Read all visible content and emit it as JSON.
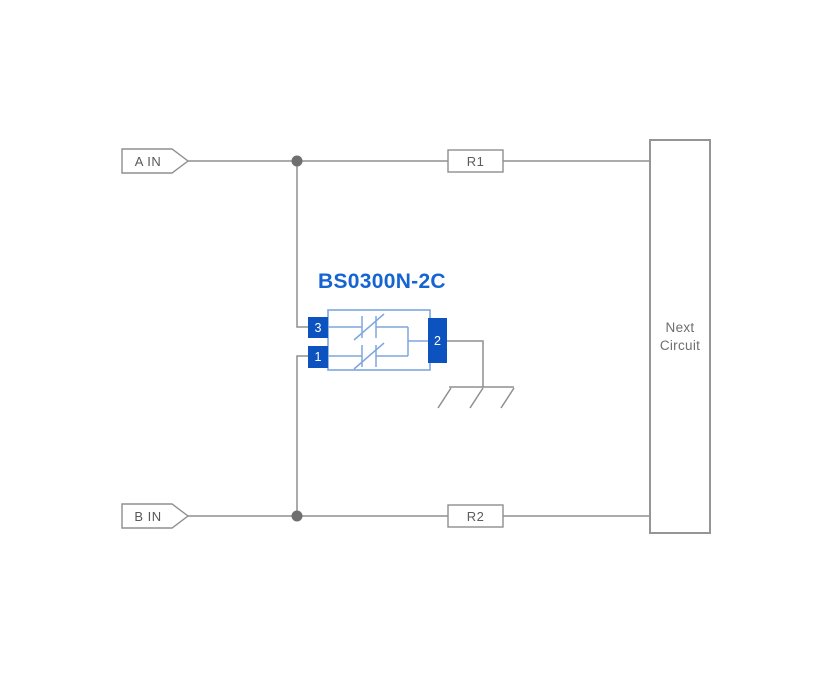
{
  "diagram": {
    "type": "circuit-schematic",
    "component": {
      "title": "BS0300N-2C",
      "pin_top_left": "3",
      "pin_bottom_left": "1",
      "pin_right": "2",
      "internal_symbol": "dual-bidirectional-esd-diode"
    },
    "input_a": "A IN",
    "input_b": "B IN",
    "resistor_1": "R1",
    "resistor_2": "R2",
    "next_circuit": {
      "line1": "Next",
      "line2": "Circuit"
    },
    "icons": {
      "junction_dot": "filled-circle",
      "ground": "chassis-ground-icon",
      "input_flag": "pointed-net-label"
    },
    "colors": {
      "wire_gray": "#8f8f8f",
      "junction_gray": "#6f6f6f",
      "box_border_gray": "#8f8f8f",
      "pin_blue": "#0d53c0",
      "body_light_blue": "#7da6de",
      "title_blue": "#1464d2",
      "label_gray": "#595959",
      "background": "#ffffff"
    }
  }
}
